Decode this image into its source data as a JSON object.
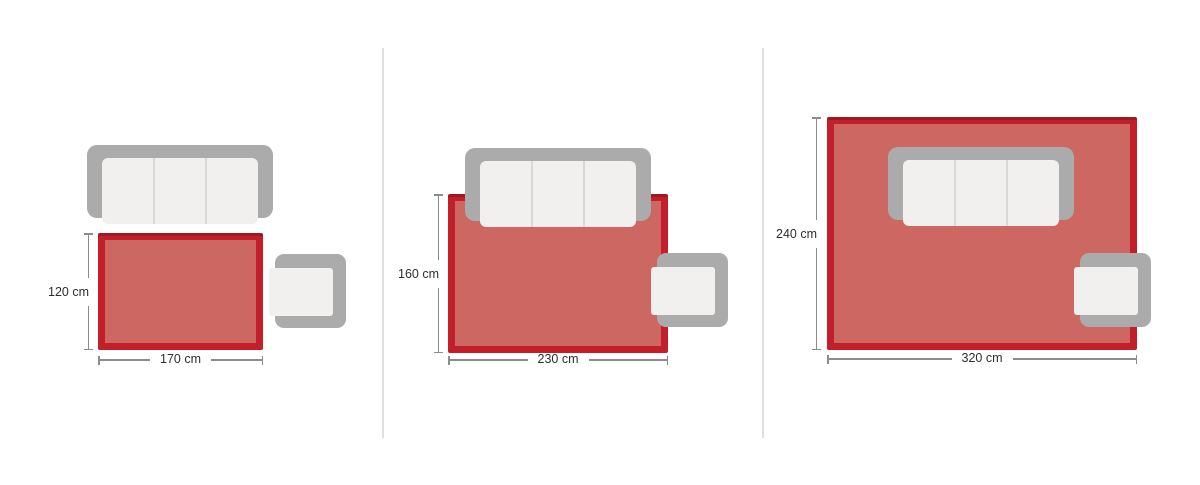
{
  "colors": {
    "rug_border": "#c21f2a",
    "rug_top_shade": "rgba(0,0,0,0.18)",
    "rug_fill": "#cd6761",
    "furniture_frame": "#ababab",
    "furniture_cushion": "#f1f0ef",
    "cushion_separator": "#d8d8d8",
    "dimension_line": "#8c8c8c",
    "dimension_text": "#2d2d2d",
    "panel_divider": "#e0e0e0"
  },
  "panels": [
    {
      "name": "rug-size-120x170",
      "height_label": "120 cm",
      "width_label": "170 cm"
    },
    {
      "name": "rug-size-160x230",
      "height_label": "160 cm",
      "width_label": "230 cm"
    },
    {
      "name": "rug-size-240x320",
      "height_label": "240 cm",
      "width_label": "320 cm"
    }
  ]
}
